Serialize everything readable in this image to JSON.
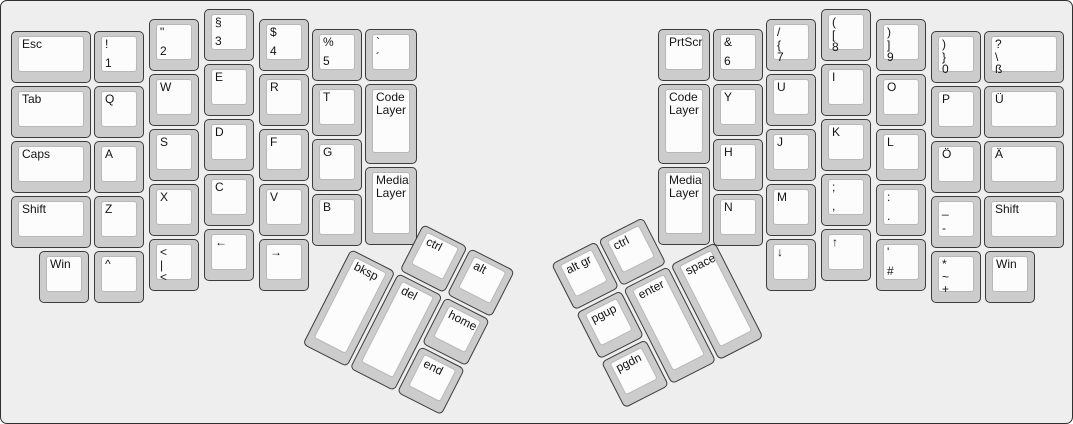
{
  "title": "Ergonomic split keyboard layout (German)",
  "colors": {
    "background": "#eeeeee",
    "key_side": "#cccccc",
    "key_top": "#fcfcfc",
    "outline": "#3c3c3c",
    "legend": "#141414"
  },
  "keys": {
    "esc": [
      "Esc"
    ],
    "n1": [
      "!",
      "1"
    ],
    "n2": [
      "\"",
      "2"
    ],
    "n3": [
      "§",
      "3"
    ],
    "n4": [
      "$",
      "4"
    ],
    "n5": [
      "%",
      "5"
    ],
    "grave": [
      "`",
      "´"
    ],
    "tab": [
      "Tab"
    ],
    "q": [
      "Q"
    ],
    "w": [
      "W"
    ],
    "e": [
      "E"
    ],
    "r": [
      "R"
    ],
    "t": [
      "T"
    ],
    "code_left": [
      "Code Layer"
    ],
    "caps": [
      "Caps"
    ],
    "a": [
      "A"
    ],
    "s": [
      "S"
    ],
    "d": [
      "D"
    ],
    "f": [
      "F"
    ],
    "g": [
      "G"
    ],
    "media_left": [
      "Media Layer"
    ],
    "shift_left": [
      "Shift"
    ],
    "z": [
      "Z"
    ],
    "x": [
      "X"
    ],
    "c": [
      "C"
    ],
    "v": [
      "V"
    ],
    "b": [
      "B"
    ],
    "win_left": [
      "Win"
    ],
    "caret": [
      "^"
    ],
    "angle": [
      "<",
      "|",
      "<"
    ],
    "arrow_left": [
      "←"
    ],
    "arrow_right": [
      "→"
    ],
    "bksp": [
      "bksp"
    ],
    "del": [
      "del"
    ],
    "ctrl_left": [
      "ctrl"
    ],
    "alt": [
      "alt"
    ],
    "home": [
      "home"
    ],
    "end": [
      "end"
    ],
    "prtscr": [
      "PrtScr"
    ],
    "n6": [
      "&",
      "6"
    ],
    "n7": [
      "/",
      "{",
      "7"
    ],
    "n8": [
      "(",
      "[",
      "8"
    ],
    "n9": [
      ")",
      "]",
      "9"
    ],
    "n0": [
      ")",
      "}",
      "0"
    ],
    "eszett": [
      "?",
      "\\",
      "ß"
    ],
    "code_right": [
      "Code Layer"
    ],
    "y": [
      "Y"
    ],
    "u": [
      "U"
    ],
    "i": [
      "I"
    ],
    "o": [
      "O"
    ],
    "p": [
      "P"
    ],
    "uuml": [
      "Ü"
    ],
    "media_right": [
      "Media Layer"
    ],
    "h": [
      "H"
    ],
    "j": [
      "J"
    ],
    "k": [
      "K"
    ],
    "l": [
      "L"
    ],
    "ouml": [
      "Ö"
    ],
    "auml": [
      "Ä"
    ],
    "n": [
      "N"
    ],
    "m": [
      "M"
    ],
    "semicolon": [
      ";",
      ","
    ],
    "colon": [
      ":",
      "."
    ],
    "underscore": [
      "_",
      "-"
    ],
    "shift_right": [
      "Shift"
    ],
    "arrow_down": [
      "↓"
    ],
    "arrow_up": [
      "↑"
    ],
    "apos_hash": [
      "'",
      "#"
    ],
    "star_plus": [
      "*",
      "~",
      "+"
    ],
    "win_right": [
      "Win"
    ],
    "altgr": [
      "alt gr"
    ],
    "ctrl_right": [
      "ctrl"
    ],
    "pgup": [
      "pgup"
    ],
    "pgdn": [
      "pgdn"
    ],
    "enter": [
      "enter"
    ],
    "space": [
      "space"
    ]
  }
}
